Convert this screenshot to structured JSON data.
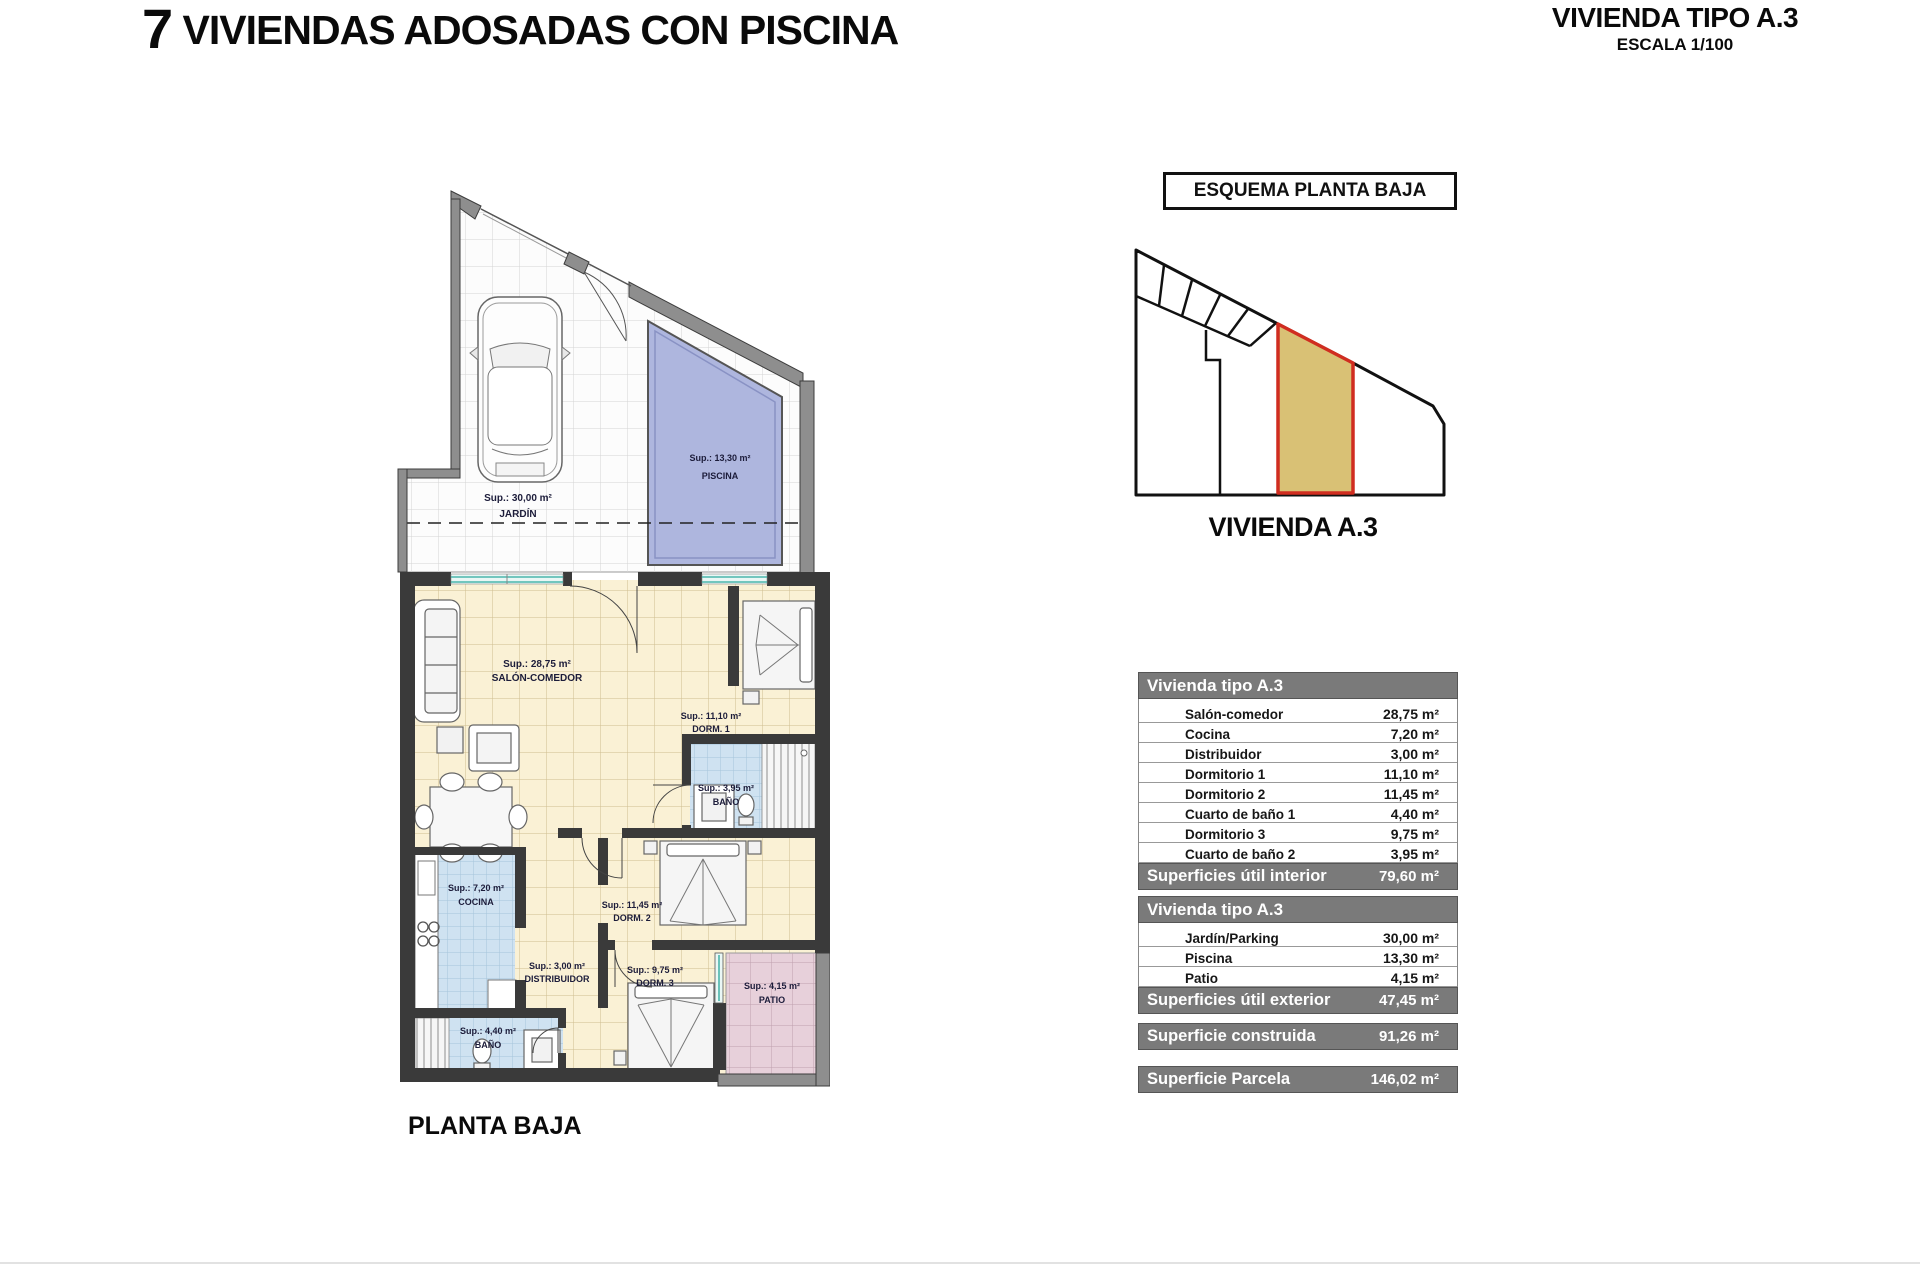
{
  "header": {
    "title_number": "7",
    "title_text": " VIVIENDAS ADOSADAS CON PISCINA"
  },
  "subheader": {
    "title": "VIVIENDA TIPO A.3",
    "scale": "ESCALA 1/100"
  },
  "esquema": {
    "box_label": "ESQUEMA PLANTA BAJA",
    "caption": "VIVIENDA A.3",
    "highlight_fill": "#d9c175",
    "highlight_border": "#d02d20"
  },
  "floorplan": {
    "caption": "PLANTA BAJA",
    "rooms": {
      "jardin": {
        "sup": "Sup.: 30,00 m²",
        "name": "JARDÍN"
      },
      "piscina": {
        "sup": "Sup.: 13,30 m²",
        "name": "PISCINA"
      },
      "salon": {
        "sup": "Sup.: 28,75 m²",
        "name": "SALÓN-COMEDOR"
      },
      "dorm1": {
        "sup": "Sup.: 11,10 m²",
        "name": "DORM. 1"
      },
      "bano1": {
        "sup": "Sup.: 3,95 m²",
        "name": "BAÑO"
      },
      "cocina": {
        "sup": "Sup.: 7,20 m²",
        "name": "COCINA"
      },
      "distribuidor": {
        "sup": "Sup.: 3,00 m²",
        "name": "DISTRIBUIDOR"
      },
      "dorm2": {
        "sup": "Sup.: 11,45 m²",
        "name": "DORM. 2"
      },
      "dorm3": {
        "sup": "Sup.: 9,75 m²",
        "name": "DORM. 3"
      },
      "bano2": {
        "sup": "Sup.: 4,40 m²",
        "name": "BAÑO"
      },
      "patio": {
        "sup": "Sup.: 4,15 m²",
        "name": "PATIO"
      }
    }
  },
  "tables": {
    "interior": {
      "header": "Vivienda tipo A.3",
      "rows": [
        {
          "label": "Salón-comedor",
          "value": "28,75 m²"
        },
        {
          "label": "Cocina",
          "value": "7,20 m²"
        },
        {
          "label": "Distribuidor",
          "value": "3,00 m²"
        },
        {
          "label": "Dormitorio 1",
          "value": "11,10 m²"
        },
        {
          "label": "Dormitorio 2",
          "value": "11,45 m²"
        },
        {
          "label": "Cuarto de baño 1",
          "value": "4,40 m²"
        },
        {
          "label": "Dormitorio 3",
          "value": "9,75 m²"
        },
        {
          "label": "Cuarto de baño 2",
          "value": "3,95 m²"
        }
      ],
      "footer_label": "Superficies útil interior",
      "footer_value": "79,60 m²"
    },
    "exterior": {
      "header": "Vivienda tipo A.3",
      "rows": [
        {
          "label": "Jardín/Parking",
          "value": "30,00 m²"
        },
        {
          "label": "Piscina",
          "value": "13,30 m²"
        },
        {
          "label": "Patio",
          "value": "4,15 m²"
        }
      ],
      "footer_label": "Superficies útil exterior",
      "footer_value": "47,45 m²"
    },
    "construida": {
      "label": "Superficie construida",
      "value": "91,26 m²"
    },
    "parcela": {
      "label": "Superficie Parcela",
      "value": "146,02 m²"
    }
  },
  "colors": {
    "table_header_bg": "#7a7a7a",
    "pool": "#aeb6de",
    "floor_cream": "#faf1d5",
    "tile_blue": "#cfe2f1",
    "patio_pink": "#e7d0da",
    "wall_dark": "#3a3a3a",
    "wall_gray": "#8e8e8e",
    "window_teal": "#4ab5ab"
  }
}
